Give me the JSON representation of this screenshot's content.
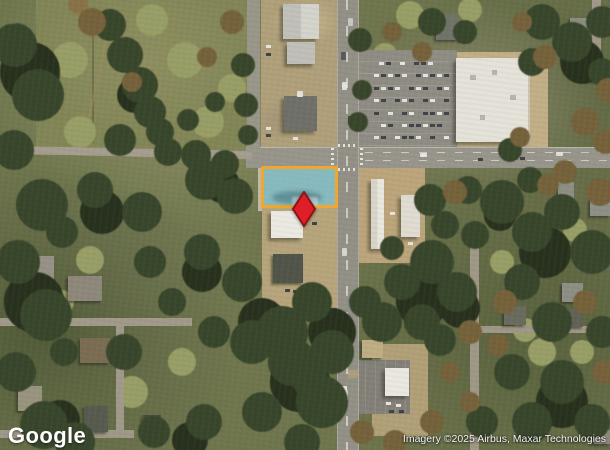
{
  "map_overlay": {
    "logo_text": "Google",
    "attribution_text": "Imagery ©2025 Airbus, Maxar Technologies"
  },
  "highlight": {
    "shape": "parcel-rectangle",
    "outline_color": "#F1A62C",
    "fill_color": "rgba(80,185,205,0.5)"
  },
  "marker": {
    "shape": "diamond-pin",
    "fill_color": "#DE1F28",
    "stroke_color": "#8E1216"
  }
}
